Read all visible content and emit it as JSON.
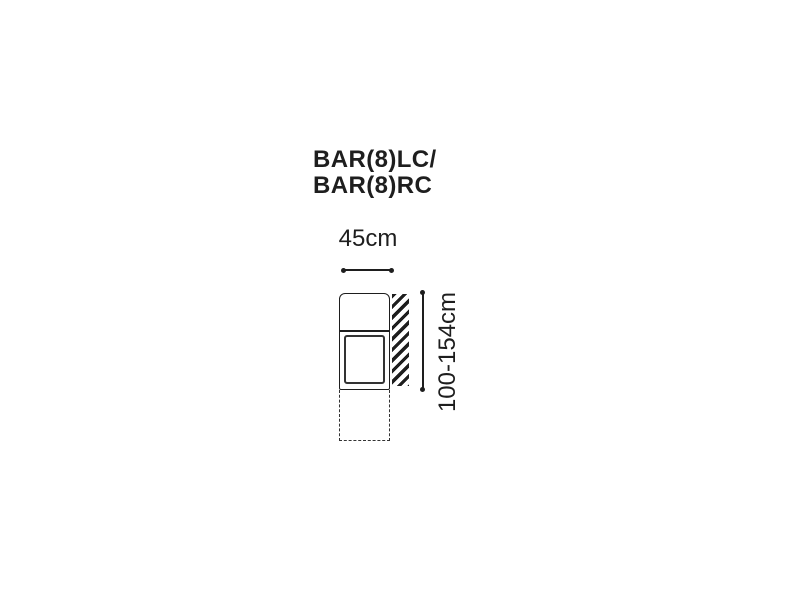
{
  "title": {
    "line1": "BAR(8)LC/",
    "line2": "BAR(8)RC"
  },
  "dimensions": {
    "width": "45cm",
    "height": "100-154cm"
  },
  "colors": {
    "ink": "#1e1e1e",
    "muted": "#333333",
    "bg": "#ffffff"
  }
}
